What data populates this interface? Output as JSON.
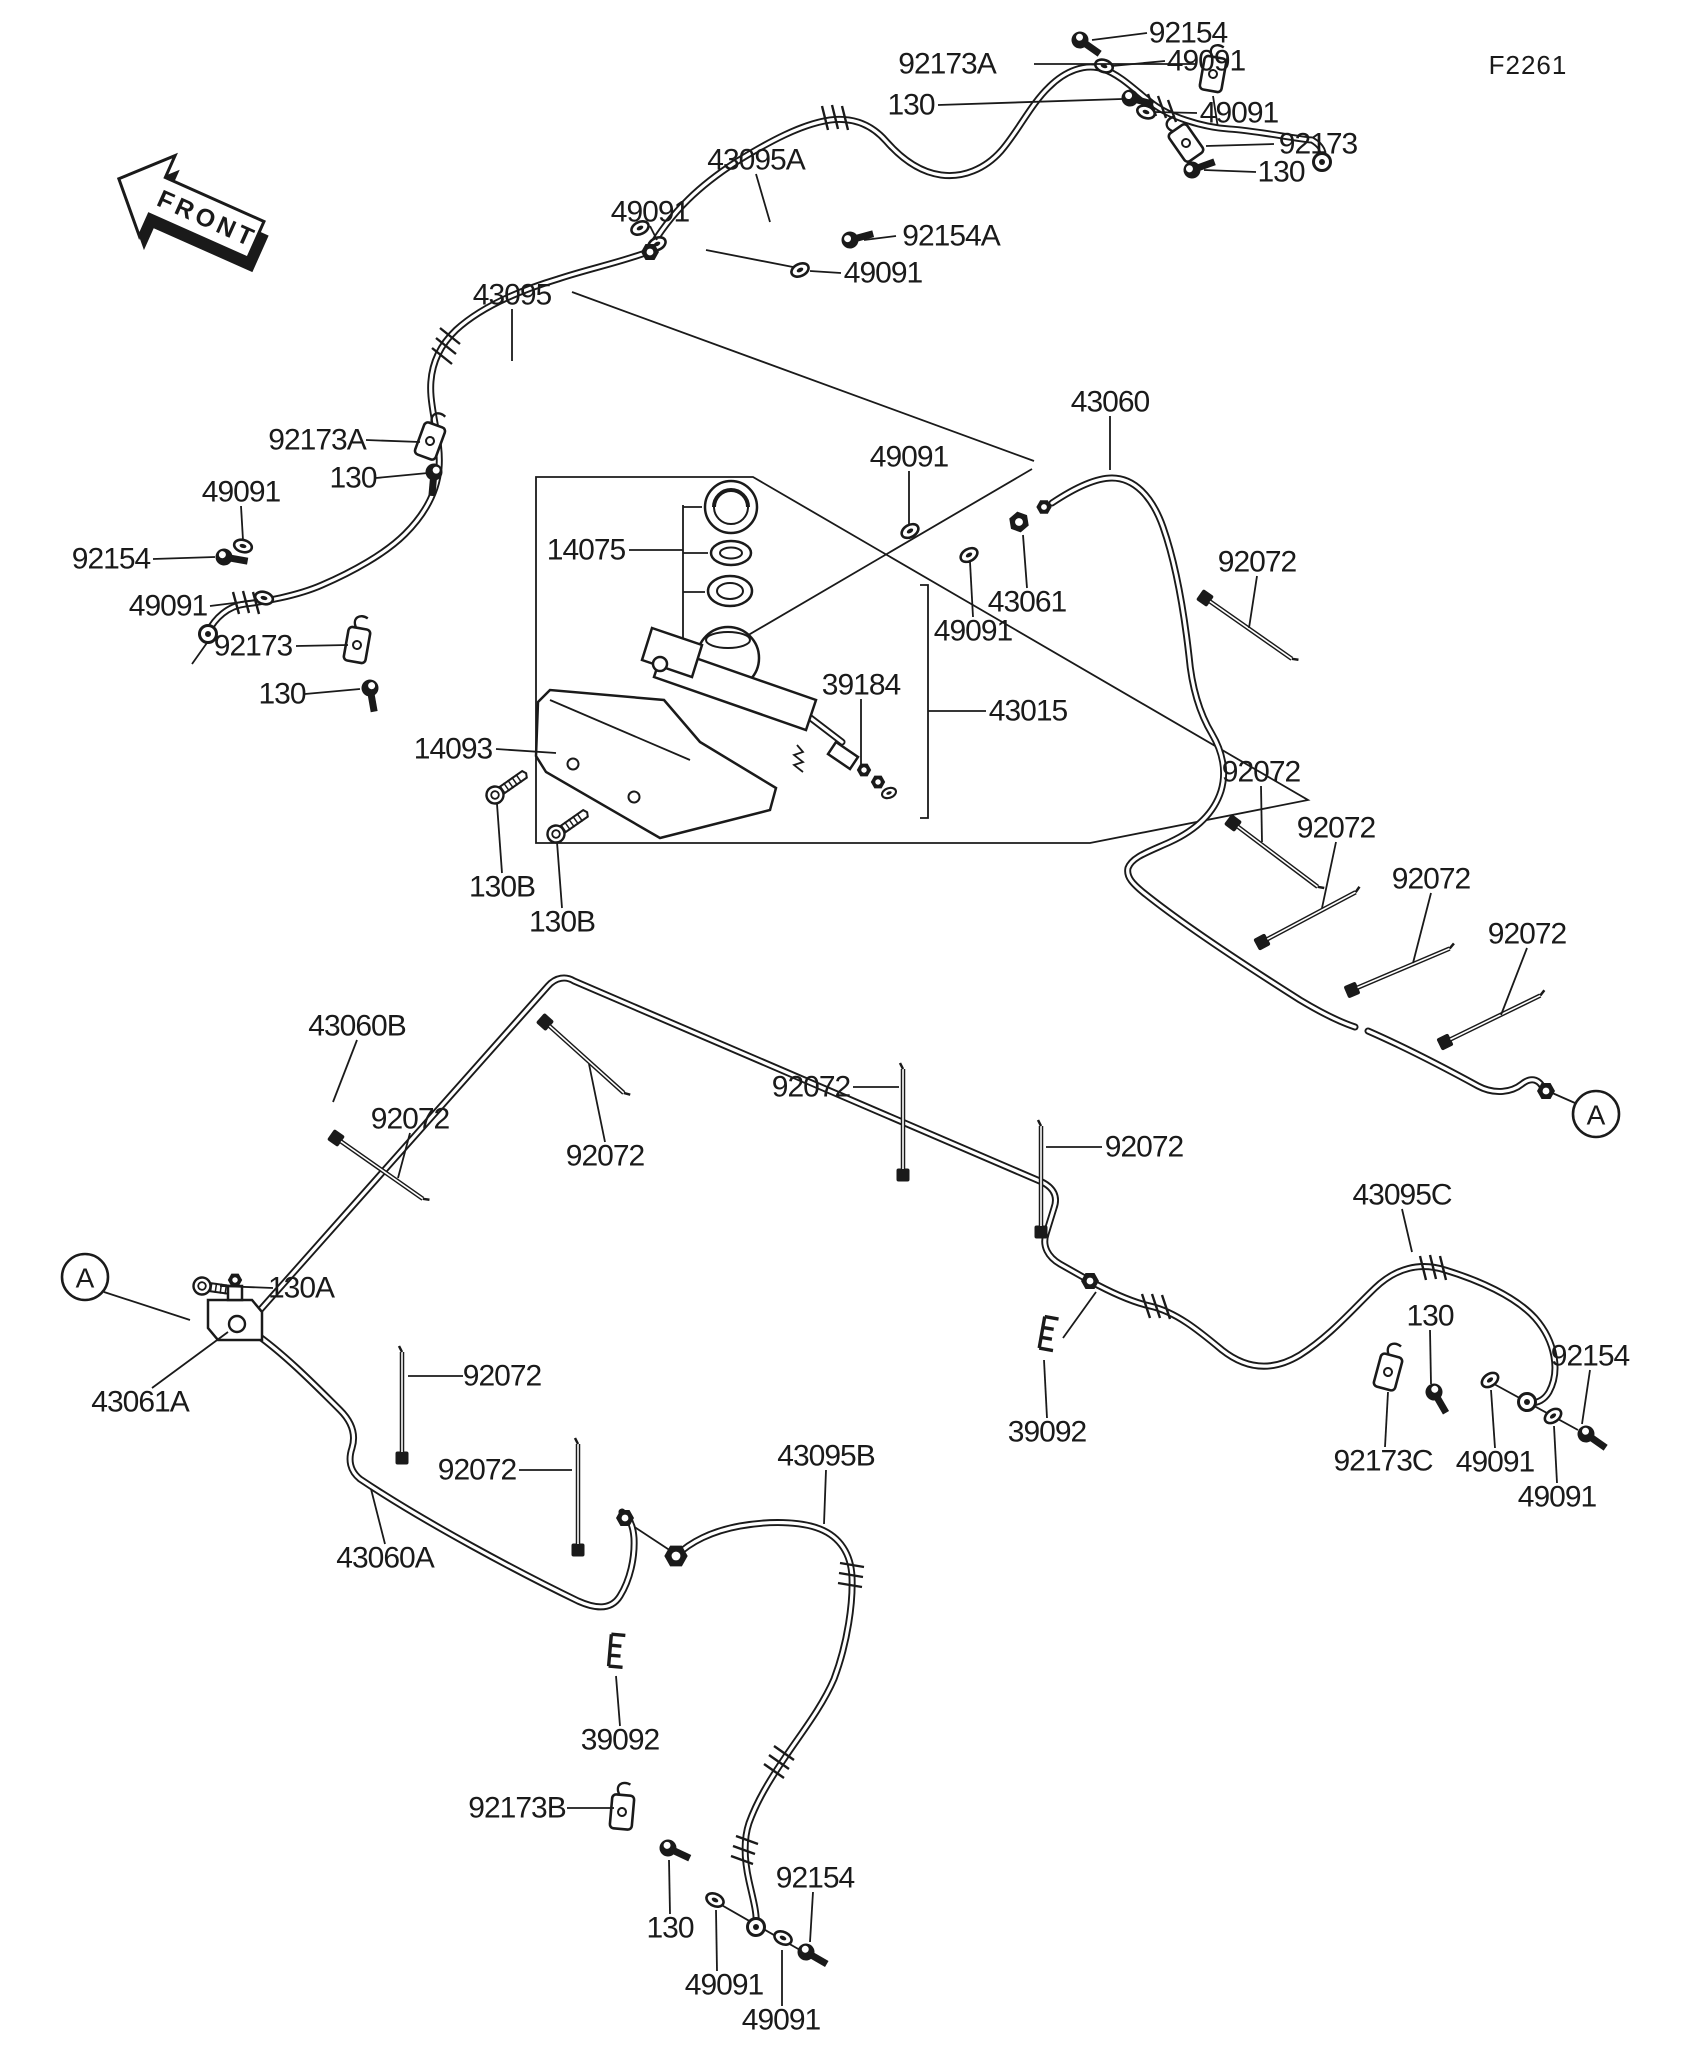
{
  "figure_code": "F2261",
  "front_marker": "FRONT",
  "ink_color": "#1a1a1a",
  "background_color": "#ffffff",
  "unique_part_numbers": [
    "130",
    "130A",
    "130B",
    "14075",
    "14093",
    "39092",
    "39184",
    "43015",
    "43060",
    "43060A",
    "43060B",
    "43061",
    "43061A",
    "43095",
    "43095A",
    "43095B",
    "43095C",
    "49091",
    "92072",
    "92154",
    "92154A",
    "92173",
    "92173A",
    "92173B",
    "92173C"
  ],
  "connectors": [
    {
      "label": "A",
      "x": 1596,
      "y": 1114,
      "l": [
        1575,
        1103,
        1550,
        1092
      ]
    },
    {
      "label": "A",
      "x": 85,
      "y": 1277,
      "l": [
        104,
        1292,
        190,
        1320
      ]
    }
  ],
  "callouts": [
    {
      "t": "92154",
      "x": 1188,
      "y": 33,
      "l": [
        1147,
        33,
        1092,
        40
      ]
    },
    {
      "t": "49091",
      "x": 1206,
      "y": 61,
      "l": [
        1165,
        61,
        1112,
        66
      ]
    },
    {
      "t": "92173A",
      "x": 947,
      "y": 64,
      "l": [
        1034,
        64,
        1196,
        64
      ]
    },
    {
      "t": "130",
      "x": 911,
      "y": 105,
      "l": [
        938,
        105,
        1122,
        99
      ]
    },
    {
      "t": "49091",
      "x": 1239,
      "y": 113,
      "l": [
        1197,
        113,
        1154,
        112
      ]
    },
    {
      "t": "92173",
      "x": 1318,
      "y": 144,
      "l": [
        1274,
        144,
        1206,
        146
      ]
    },
    {
      "t": "130",
      "x": 1281,
      "y": 172,
      "l": [
        1256,
        172,
        1204,
        170
      ]
    },
    {
      "t": "43095A",
      "x": 756,
      "y": 160,
      "l": [
        756,
        174,
        770,
        222
      ]
    },
    {
      "t": "49091",
      "x": 650,
      "y": 212,
      "l": [
        650,
        226,
        657,
        240
      ]
    },
    {
      "t": "92154A",
      "x": 951,
      "y": 236,
      "l": [
        896,
        236,
        864,
        240
      ]
    },
    {
      "t": "49091",
      "x": 883,
      "y": 273,
      "l": [
        841,
        273,
        810,
        271
      ]
    },
    {
      "t": "43095",
      "x": 512,
      "y": 295,
      "l": [
        512,
        309,
        512,
        361
      ]
    },
    {
      "t": "92173A",
      "x": 317,
      "y": 440,
      "l": [
        366,
        440,
        420,
        442
      ]
    },
    {
      "t": "130",
      "x": 353,
      "y": 478,
      "l": [
        376,
        478,
        428,
        473
      ]
    },
    {
      "t": "49091",
      "x": 241,
      "y": 492,
      "l": [
        241,
        506,
        243,
        540
      ]
    },
    {
      "t": "92154",
      "x": 111,
      "y": 559,
      "l": [
        153,
        559,
        215,
        557
      ]
    },
    {
      "t": "49091",
      "x": 168,
      "y": 606,
      "l": [
        210,
        606,
        258,
        600
      ]
    },
    {
      "t": "92173",
      "x": 253,
      "y": 646,
      "l": [
        296,
        646,
        348,
        645
      ]
    },
    {
      "t": "130",
      "x": 282,
      "y": 694,
      "l": [
        305,
        694,
        360,
        689
      ]
    },
    {
      "t": "14075",
      "x": 586,
      "y": 550,
      "l": [
        629,
        550,
        683,
        550
      ]
    },
    {
      "t": "49091",
      "x": 909,
      "y": 457,
      "l": [
        909,
        471,
        909,
        524
      ]
    },
    {
      "t": "43060",
      "x": 1110,
      "y": 402,
      "l": [
        1110,
        416,
        1110,
        470
      ]
    },
    {
      "t": "43061",
      "x": 1027,
      "y": 602,
      "l": [
        1027,
        588,
        1023,
        535
      ]
    },
    {
      "t": "49091",
      "x": 973,
      "y": 631,
      "l": [
        973,
        617,
        970,
        562
      ]
    },
    {
      "t": "39184",
      "x": 861,
      "y": 685,
      "l": [
        861,
        699,
        861,
        764
      ]
    },
    {
      "t": "43015",
      "x": 1028,
      "y": 711,
      "l": [
        986,
        711,
        928,
        711
      ]
    },
    {
      "t": "14093",
      "x": 453,
      "y": 749,
      "l": [
        496,
        749,
        556,
        753
      ]
    },
    {
      "t": "130B",
      "x": 502,
      "y": 887,
      "l": [
        502,
        873,
        497,
        804
      ]
    },
    {
      "t": "130B",
      "x": 562,
      "y": 922,
      "l": [
        562,
        908,
        557,
        842
      ]
    },
    {
      "t": "92072",
      "x": 1257,
      "y": 562,
      "l": [
        1257,
        576,
        1249,
        628
      ]
    },
    {
      "t": "92072",
      "x": 1261,
      "y": 772,
      "l": [
        1261,
        786,
        1262,
        842
      ]
    },
    {
      "t": "92072",
      "x": 1336,
      "y": 828,
      "l": [
        1336,
        842,
        1322,
        908
      ]
    },
    {
      "t": "92072",
      "x": 1431,
      "y": 879,
      "l": [
        1431,
        893,
        1413,
        963
      ]
    },
    {
      "t": "92072",
      "x": 1527,
      "y": 934,
      "l": [
        1527,
        948,
        1501,
        1015
      ]
    },
    {
      "t": "43060B",
      "x": 357,
      "y": 1026,
      "l": [
        357,
        1040,
        333,
        1102
      ]
    },
    {
      "t": "92072",
      "x": 410,
      "y": 1119,
      "l": [
        410,
        1133,
        398,
        1178
      ]
    },
    {
      "t": "92072",
      "x": 605,
      "y": 1156,
      "l": [
        605,
        1142,
        589,
        1064
      ]
    },
    {
      "t": "92072",
      "x": 811,
      "y": 1087,
      "l": [
        853,
        1087,
        899,
        1087
      ]
    },
    {
      "t": "92072",
      "x": 1144,
      "y": 1147,
      "l": [
        1102,
        1147,
        1046,
        1147
      ]
    },
    {
      "t": "43095C",
      "x": 1402,
      "y": 1195,
      "l": [
        1402,
        1209,
        1412,
        1252
      ]
    },
    {
      "t": "130",
      "x": 1430,
      "y": 1316,
      "l": [
        1430,
        1330,
        1431,
        1384
      ]
    },
    {
      "t": "92154",
      "x": 1590,
      "y": 1356,
      "l": [
        1590,
        1370,
        1582,
        1424
      ]
    },
    {
      "t": "92173C",
      "x": 1383,
      "y": 1461,
      "l": [
        1385,
        1447,
        1388,
        1392
      ]
    },
    {
      "t": "49091",
      "x": 1495,
      "y": 1462,
      "l": [
        1495,
        1448,
        1491,
        1390
      ]
    },
    {
      "t": "49091",
      "x": 1557,
      "y": 1497,
      "l": [
        1557,
        1483,
        1554,
        1426
      ]
    },
    {
      "t": "39092",
      "x": 1047,
      "y": 1432,
      "l": [
        1047,
        1418,
        1044,
        1360
      ]
    },
    {
      "t": "130A",
      "x": 301,
      "y": 1288,
      "l": [
        273,
        1288,
        220,
        1286
      ]
    },
    {
      "t": "43061A",
      "x": 140,
      "y": 1402,
      "l": [
        152,
        1388,
        228,
        1332
      ]
    },
    {
      "t": "92072",
      "x": 502,
      "y": 1376,
      "l": [
        463,
        1376,
        408,
        1376
      ]
    },
    {
      "t": "92072",
      "x": 477,
      "y": 1470,
      "l": [
        519,
        1470,
        572,
        1470
      ]
    },
    {
      "t": "43060A",
      "x": 385,
      "y": 1558,
      "l": [
        385,
        1544,
        371,
        1489
      ]
    },
    {
      "t": "43095B",
      "x": 826,
      "y": 1456,
      "l": [
        826,
        1470,
        824,
        1524
      ]
    },
    {
      "t": "39092",
      "x": 620,
      "y": 1740,
      "l": [
        620,
        1726,
        616,
        1676
      ]
    },
    {
      "t": "92173B",
      "x": 517,
      "y": 1808,
      "l": [
        567,
        1808,
        614,
        1808
      ]
    },
    {
      "t": "130",
      "x": 670,
      "y": 1928,
      "l": [
        670,
        1914,
        669,
        1860
      ]
    },
    {
      "t": "92154",
      "x": 815,
      "y": 1878,
      "l": [
        813,
        1892,
        810,
        1942
      ]
    },
    {
      "t": "49091",
      "x": 724,
      "y": 1985,
      "l": [
        717,
        1971,
        716,
        1910
      ]
    },
    {
      "t": "49091",
      "x": 781,
      "y": 2020,
      "l": [
        782,
        2006,
        782,
        1950
      ]
    }
  ]
}
